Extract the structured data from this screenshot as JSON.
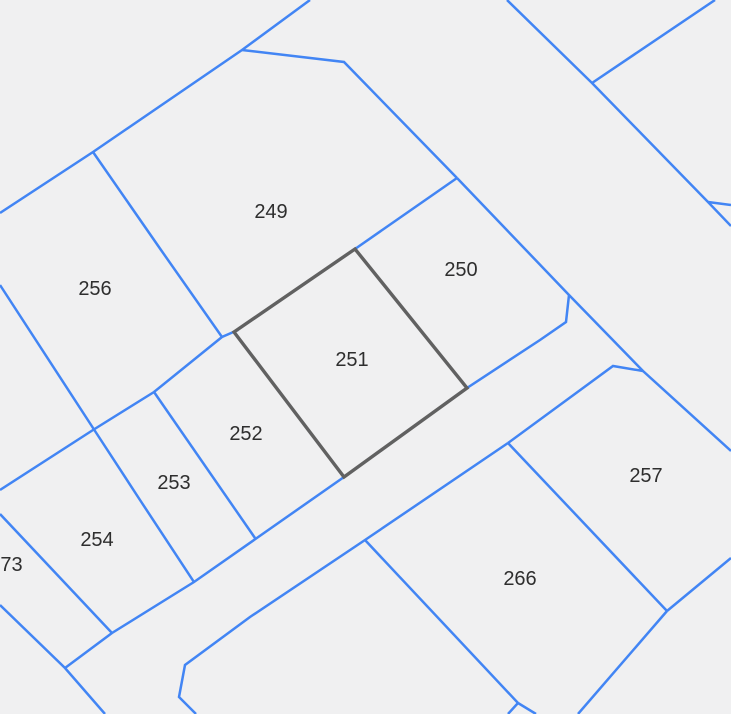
{
  "map": {
    "canvas": {
      "width": 731,
      "height": 714
    },
    "colors": {
      "background": "#f0f0f1",
      "boundary_line": "#4285f4",
      "highlight_outline": "#616161",
      "label_text": "#2e2e2e"
    },
    "line_widths": {
      "boundary": 2.5,
      "highlight": 3.4
    },
    "parcel_labels": [
      {
        "id": "249",
        "label": "249",
        "x": 271,
        "y": 212
      },
      {
        "id": "250",
        "label": "250",
        "x": 461,
        "y": 270
      },
      {
        "id": "251",
        "label": "251",
        "x": 352,
        "y": 360
      },
      {
        "id": "252",
        "label": "252",
        "x": 246,
        "y": 434
      },
      {
        "id": "253",
        "label": "253",
        "x": 174,
        "y": 483
      },
      {
        "id": "254",
        "label": "254",
        "x": 97,
        "y": 540
      },
      {
        "id": "256",
        "label": "256",
        "x": 95,
        "y": 289
      },
      {
        "id": "257",
        "label": "257",
        "x": 646,
        "y": 476
      },
      {
        "id": "266",
        "label": "266",
        "x": 520,
        "y": 579
      },
      {
        "id": "573",
        "label": "573",
        "x": 6,
        "y": 565
      }
    ],
    "highlighted_parcel": {
      "id": "251",
      "points": "234,332 355,249 467,388 344,477"
    },
    "boundary_lines": [
      {
        "name": "upper-left-long-diagonal",
        "points": "0,213 93,152 242,50 310,0"
      },
      {
        "name": "divider-249-256",
        "points": "93,152 161,250 222,337"
      },
      {
        "name": "strip-nw-boundary",
        "points": "0,490 93,430 154,392 222,337 238,330"
      },
      {
        "name": "boundary-250-nw",
        "points": "355,249 457,178"
      },
      {
        "name": "boundary-249-250-top",
        "points": "242,50 344,62 457,178"
      },
      {
        "name": "mid-long-diagonal-ne",
        "points": "457,178 569,295 643,371 731,451"
      },
      {
        "name": "zigzag-east-of-251",
        "points": "569,295 566,322 540,340 467,388"
      },
      {
        "name": "road-nw-edge",
        "points": "467,388 344,477 194,582 112,633 65,668"
      },
      {
        "name": "notch-257-top",
        "points": "643,371 613,366 508,443"
      },
      {
        "name": "road-se-edge",
        "points": "508,443 365,540 250,617 185,665 179,697 196,714"
      },
      {
        "name": "divider-252-253",
        "points": "154,392 255,538"
      },
      {
        "name": "divider-253-254",
        "points": "0,285 95,431 140,500 194,582"
      },
      {
        "name": "divider-254-573",
        "points": "0,514 112,633"
      },
      {
        "name": "divider-573-sw",
        "points": "0,605 65,668 105,714"
      },
      {
        "name": "boundary-266-nw",
        "points": "365,540 518,703"
      },
      {
        "name": "bottom-spur-left",
        "points": "518,703 508,714"
      },
      {
        "name": "bottom-spur-right",
        "points": "518,703 536,714"
      },
      {
        "name": "divider-266-257",
        "points": "508,443 667,611"
      },
      {
        "name": "boundary-257-se",
        "points": "731,558 667,611"
      },
      {
        "name": "boundary-266-se",
        "points": "667,611 578,714"
      },
      {
        "name": "top-right-long-diagonal",
        "points": "507,0 592,83 708,202 731,226"
      },
      {
        "name": "top-right-v-branch",
        "points": "592,83 715,0"
      },
      {
        "name": "right-edge-spur",
        "points": "708,202 731,205"
      }
    ]
  }
}
